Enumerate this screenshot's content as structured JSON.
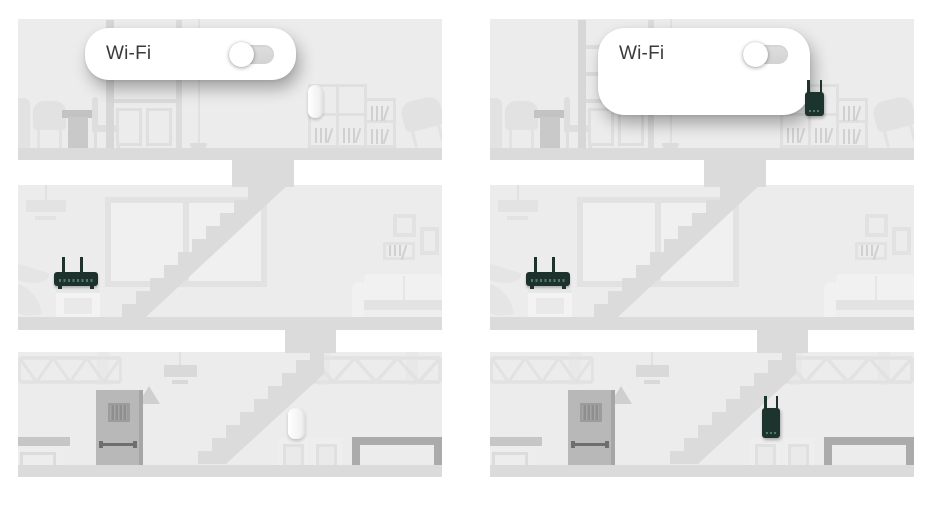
{
  "scene": {
    "description": "Two three-storey house cross-sections comparing Wi-Fi range extender placement",
    "card": {
      "label": "Wi-Fi",
      "toggle_state": "off"
    },
    "panels": [
      {
        "name": "left",
        "card_size": "small",
        "extender_state": "white",
        "devices": [
          "router",
          "shelf-extender-idle",
          "basement-extender-idle"
        ]
      },
      {
        "name": "right",
        "card_size": "large",
        "extender_state": "dark",
        "devices": [
          "router",
          "shelf-extender-active",
          "basement-extender-active"
        ]
      }
    ],
    "icons": {
      "toggle": "toggle-off-icon",
      "router": "router-icon",
      "extender": "extender-icon"
    },
    "colors": {
      "background": "#ffffff",
      "wall": "#ececec",
      "floor_band": "#dbdbdb",
      "furniture_light": "#e2e2e2",
      "furniture_dark": "#b8b8b8",
      "door_grille": "#8e8e8e",
      "device_dark": "#1d332e",
      "device_led": "#4e7a6b",
      "extender_idle": "#fbfbfb",
      "card_bg": "#ffffff",
      "card_text": "#3a3a3a",
      "toggle_track": "#d8d8d8",
      "toggle_knob": "#ffffff"
    }
  }
}
